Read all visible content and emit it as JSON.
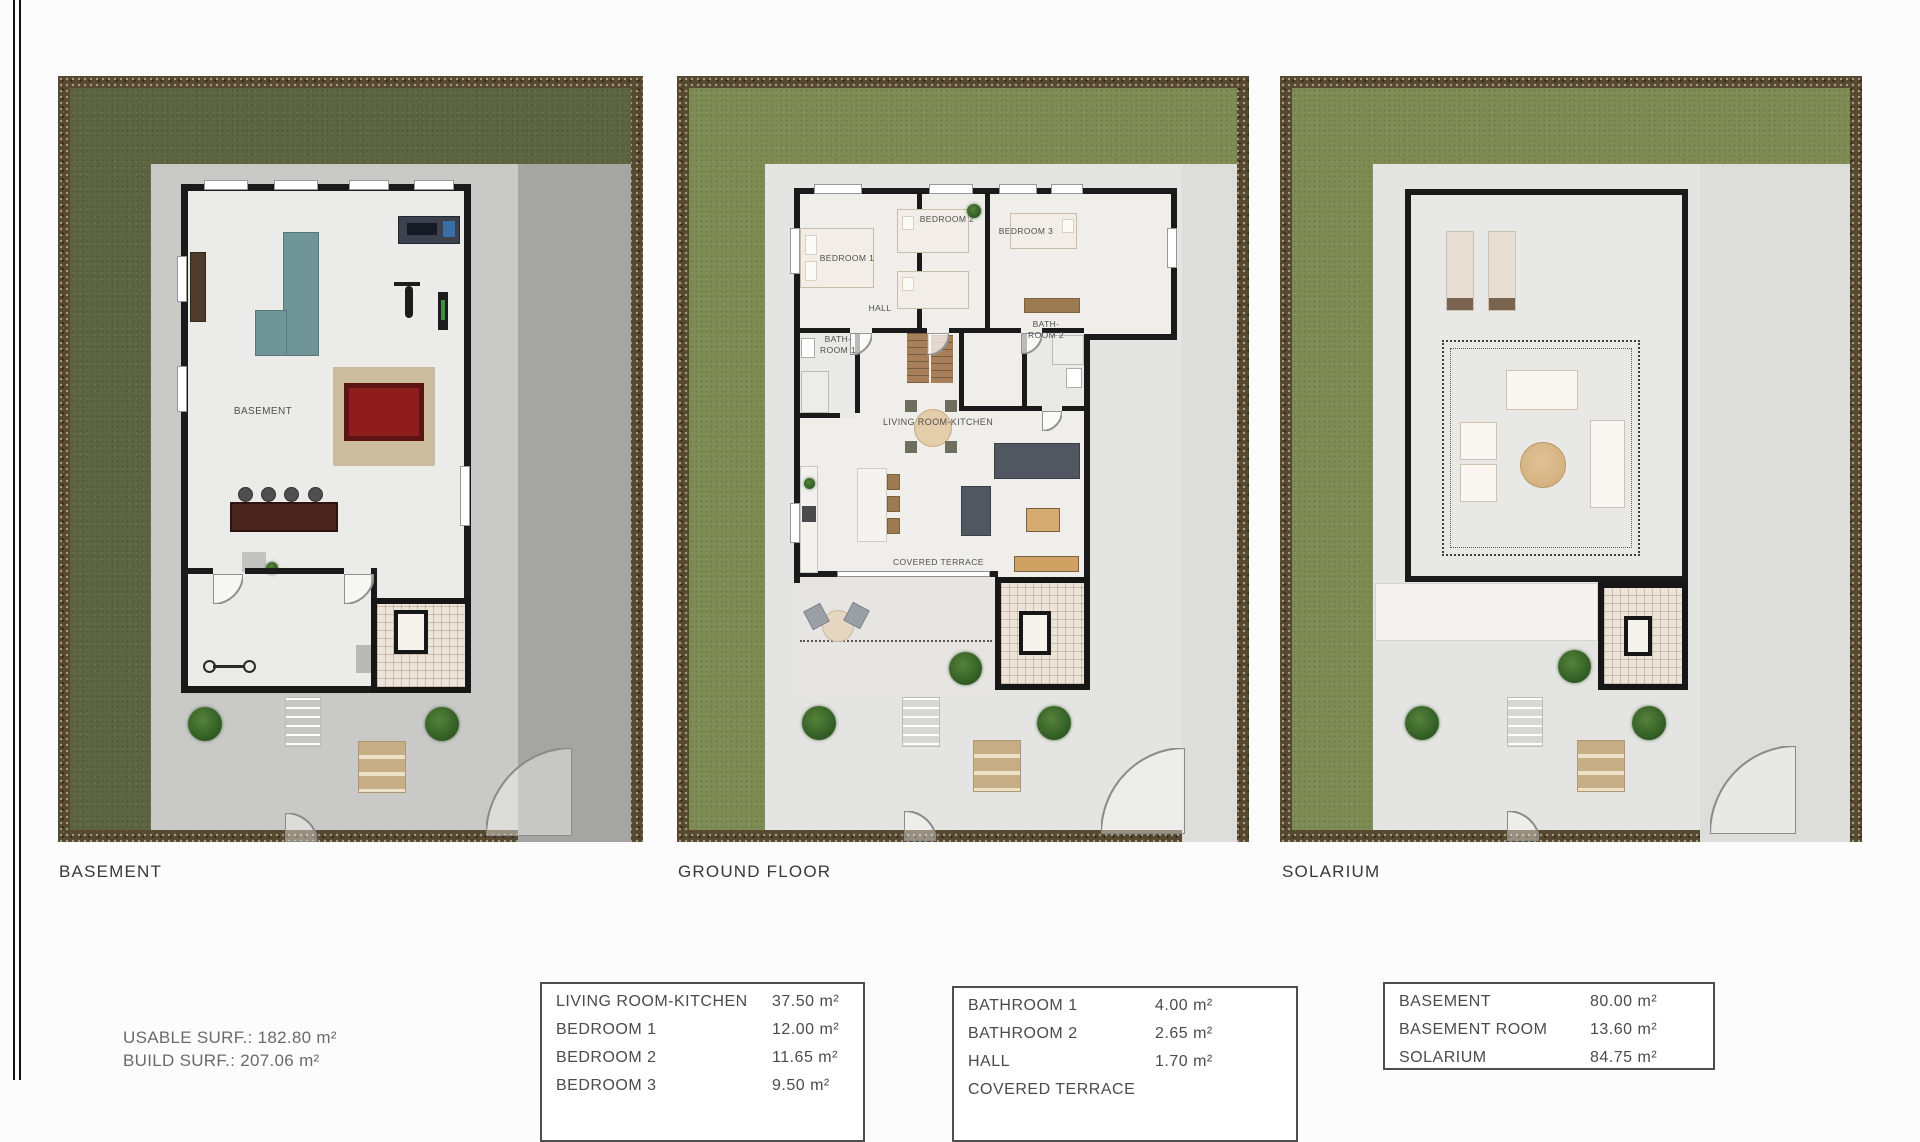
{
  "plans": [
    {
      "title": "BASEMENT",
      "labels": {
        "room": "BASEMENT"
      }
    },
    {
      "title": "GROUND FLOOR",
      "labels": {
        "bedroom1": "BEDROOM 1",
        "bedroom2": "BEDROOM 2",
        "bedroom3": "BEDROOM 3",
        "hall": "HALL",
        "bath1_l1": "BATH-",
        "bath1_l2": "ROOM 1",
        "bath2_l1": "BATH-",
        "bath2_l2": "ROOM 2",
        "living": "LIVING ROOM-KITCHEN",
        "terrace": "COVERED TERRACE"
      }
    },
    {
      "title": "SOLARIUM",
      "labels": {}
    }
  ],
  "summary": [
    {
      "label": "USABLE SURF.:",
      "value": "182.80 m²"
    },
    {
      "label": "BUILD SURF.:",
      "value": "207.06 m²"
    }
  ],
  "area_tables": [
    {
      "rows": [
        {
          "label": "LIVING ROOM-KITCHEN",
          "value": "37.50 m²"
        },
        {
          "label": "BEDROOM 1",
          "value": "12.00 m²"
        },
        {
          "label": "BEDROOM 2",
          "value": "11.65 m²"
        },
        {
          "label": "BEDROOM 3",
          "value": "9.50 m²"
        }
      ]
    },
    {
      "rows": [
        {
          "label": "BATHROOM 1",
          "value": "4.00 m²"
        },
        {
          "label": "BATHROOM 2",
          "value": "2.65 m²"
        },
        {
          "label": "HALL",
          "value": "1.70 m²"
        },
        {
          "label": "COVERED TERRACE",
          "value": ""
        }
      ]
    },
    {
      "rows": [
        {
          "label": "BASEMENT",
          "value": "80.00 m²"
        },
        {
          "label": "BASEMENT ROOM",
          "value": "13.60 m²"
        },
        {
          "label": "SOLARIUM",
          "value": "84.75 m²"
        }
      ]
    }
  ],
  "colors": {
    "grass_green": "#7e8b55",
    "grass_dark": "#5c6440",
    "gravel_brown": "#57492f",
    "pool_table_red": "#8f1d1d",
    "sofa_teal": "#6f9596",
    "wall_black": "#1a1a1a"
  }
}
